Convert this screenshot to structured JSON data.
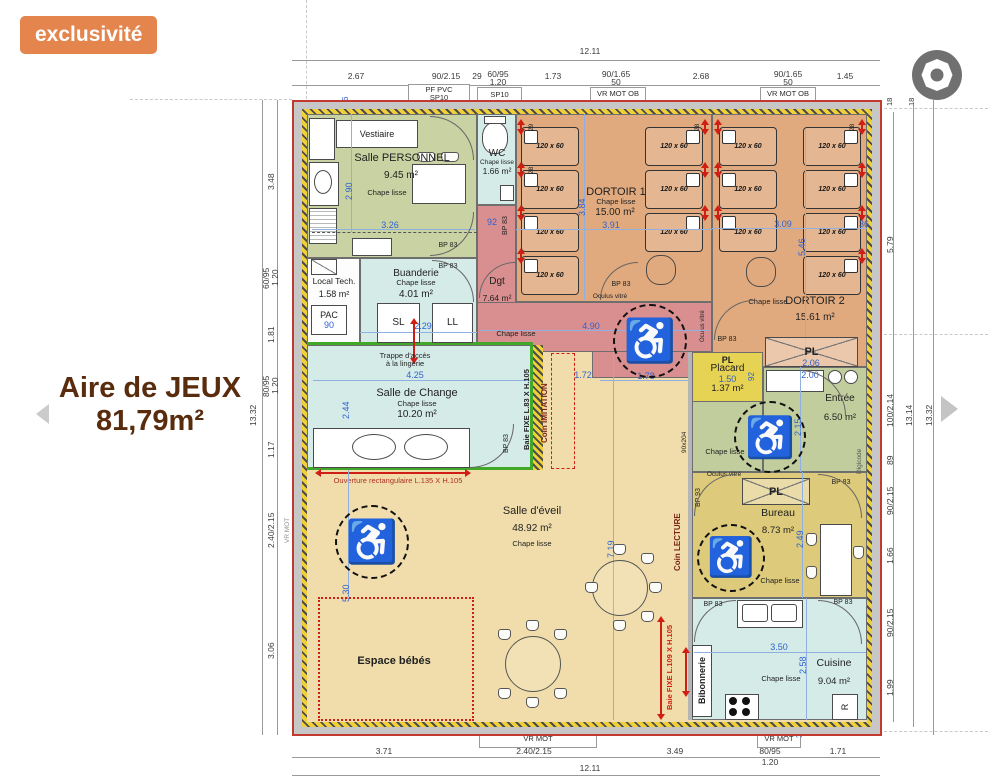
{
  "badge": {
    "label": "exclusivité"
  },
  "overlay": {
    "title_line1": "Aire de JEUX",
    "title_line2": "81,79m²"
  },
  "icons": {
    "wheelchair": "♿"
  },
  "colors": {
    "badge": "#e5854e",
    "plan_outline": "#c23a2e",
    "dortoir": "#e0aa7e",
    "wet_rooms": "#d5ebe7",
    "degagement": "#d98f8f",
    "placard": "#e6d253",
    "bureau": "#ddca7a",
    "eveil": "#f0ddab",
    "green_rooms": "#c9d2a2"
  },
  "common": {
    "chape_lisse": "Chape lisse",
    "bed_size": "120 x 60",
    "bp83": "BP 83",
    "bp93": "BP 93",
    "pl": "PL",
    "oculus": "Oculus vitré",
    "n36": "36",
    "n92": "92",
    "n18": "18",
    "n28": "28",
    "n29": "29"
  },
  "rooms": {
    "vestiaire": {
      "name": "Vestiaire"
    },
    "personnel": {
      "name": "Salle PERSONNEL",
      "area": "9.45 m²",
      "w": "3.26",
      "h": "2.90"
    },
    "wc": {
      "name": "WC",
      "area": "1.66 m²"
    },
    "dortoir1": {
      "name": "DORTOIR 1",
      "area": "15.00 m²",
      "w": "3.91",
      "h": "3.84"
    },
    "dortoir2": {
      "name": "DORTOIR 2",
      "area": "15.61 m²",
      "w": "3.09",
      "h": "5.46",
      "wr": "36",
      "pl_w": "2.06"
    },
    "local_tech": {
      "name": "Local Tech.",
      "area": "1.58 m²",
      "pac": "PAC",
      "pac_w": "90"
    },
    "buanderie": {
      "name": "Buanderie",
      "area": "4.01 m²",
      "w": "2.29",
      "sl": "SL",
      "ll": "LL"
    },
    "dgt": {
      "name": "Dgt",
      "area": "7.64 m²",
      "w": "4.90",
      "w2": "1.78"
    },
    "trappe": {
      "line1": "Trappe d'accès",
      "line2": "à la lingerie"
    },
    "placard": {
      "name": "Placard",
      "area": "1.37 m²",
      "w": "1.50"
    },
    "entree": {
      "name": "Entrée",
      "area": "6.50 m²",
      "w": "2.00",
      "h": "2.15",
      "digicode": "Digicode",
      "door_size": "90x204"
    },
    "change": {
      "name": "Salle de Change",
      "area": "10.20 m²",
      "w": "4.25",
      "h": "2.44",
      "opening": "Ouverture rectangulaire L.135 X H.105"
    },
    "imitation": {
      "name": "Coin IMITATION",
      "baie": "Baie FIXE L.83 X H.105",
      "w": "1.72"
    },
    "eveil": {
      "name": "Salle d'éveil",
      "area": "48.92 m²",
      "w": "7.19",
      "h": "5.30"
    },
    "bebes": {
      "name": "Espace bébés"
    },
    "lecture": {
      "name": "Coin LECTURE",
      "baie": "Baie FIXE L.109 X H.105"
    },
    "bureau": {
      "name": "Bureau",
      "area": "8.73 m²",
      "h": "2.49"
    },
    "bibonnerie": {
      "name": "Bibonnerie"
    },
    "cuisine": {
      "name": "Cuisine",
      "area": "9.04 m²",
      "w": "3.50",
      "h": "2.58",
      "fridge": "R"
    },
    "seuil_left": {
      "label": "Seuil encastré PMR",
      "sub": "VR MOT"
    }
  },
  "dims": {
    "top": {
      "overall": "12.11",
      "s1": "2.67",
      "s2": "90/2.15",
      "s3": "29",
      "s4a": "60/95",
      "s4b": "1.20",
      "s5": "1.73",
      "s6a": "90/1.65",
      "s6b": "50",
      "s7": "2.68",
      "s8a": "90/1.65",
      "s8b": "50",
      "s9": "1.45"
    },
    "bottom": {
      "overall": "12.11",
      "s1": "3.71",
      "s2": "2.40/2.15",
      "s3": "3.49",
      "s4a": "80/95",
      "s4b": "1.20",
      "s5": "1.71"
    },
    "left": {
      "overall": "13.32",
      "s1": "3.48",
      "s2a": "60/95",
      "s2b": "1.20",
      "s3": "1.81",
      "s4a": "80/95",
      "s4b": "1.20",
      "s5": "1.17",
      "s6": "2.40/2.15",
      "s7": "3.06"
    },
    "right": {
      "overall": "13.32",
      "inner": "13.14",
      "s1": "5.79",
      "s2": "100/2.14",
      "s3": "89",
      "s4": "90/2.15",
      "s5": "1.66",
      "s6": "90/2.15",
      "s7": "1.99"
    }
  },
  "wall_labels": {
    "t1a": "PF PVC",
    "t1b": "SP10",
    "t1c": "vitrée",
    "t2a": "SP10",
    "t2b": "PVC",
    "t3a": "VR MOT OB",
    "t3b": "PVC",
    "t4a": "VR MOT OB",
    "t4b": "PVC",
    "b1a": "Seuil encastré PMR",
    "b1b": "VR MOT",
    "b2a": "PVC",
    "b2b": "VR MOT",
    "l1a": "SP10 OB",
    "l1b": "PVC",
    "l2a": "SP10",
    "l2b": "PVC",
    "r1a": "Porte d'entrée",
    "r1b": "ACIER",
    "r2a": "PF PVC",
    "r2b": "SP10",
    "r3a": "PF PVC",
    "r3b": "SP10"
  }
}
